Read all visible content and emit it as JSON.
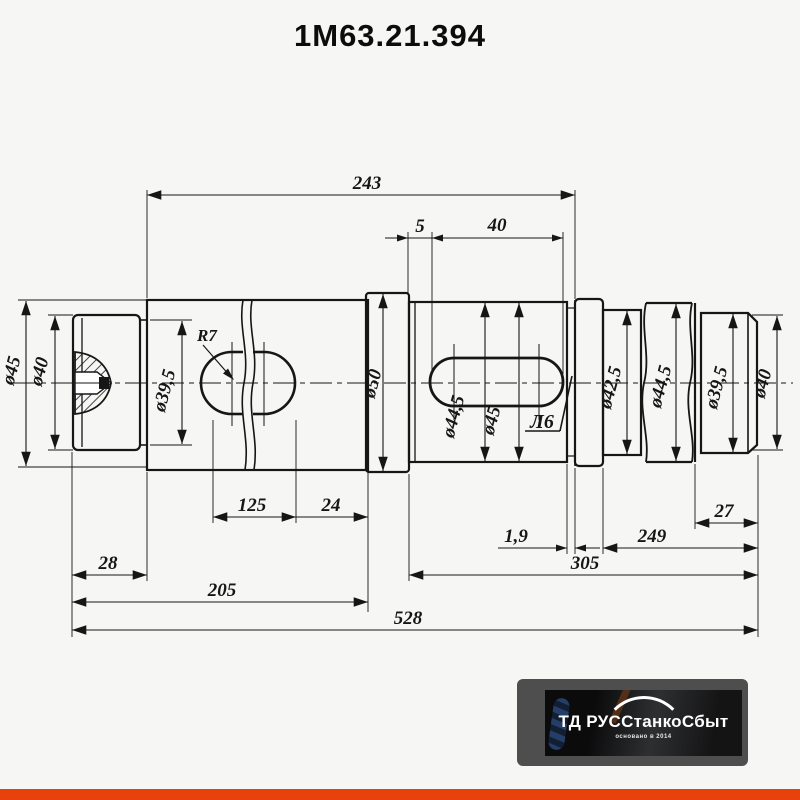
{
  "title": "1М63.21.394",
  "dims": {
    "overall_top": "243",
    "offset_5": "5",
    "keyway_len": "40",
    "radius": "R7",
    "len_125": "125",
    "len_24": "24",
    "len_28": "28",
    "len_205": "205",
    "groove_width": "1,9",
    "len_249": "249",
    "len_27": "27",
    "len_305": "305",
    "overall": "528"
  },
  "dia": {
    "left_45": "ø45",
    "left_40": "ø40",
    "left_39_5": "ø39,5",
    "mid_50": "ø50",
    "key_44_5": "ø44,5",
    "key_45": "ø45",
    "right_42_5": "ø42,5",
    "right_44_5": "ø44,5",
    "right_39_5": "ø39,5",
    "right_40": "ø40"
  },
  "marks": {
    "datum_flag": "Л6"
  },
  "logo": {
    "name": "ТД РУССтанкоСбыт",
    "tagline": "основано в 2014"
  },
  "colors": {
    "ink": "#161616",
    "accent_bar": "#e8420c",
    "logo_frame": "#4e4e4e",
    "logo_photo": "#141415"
  }
}
